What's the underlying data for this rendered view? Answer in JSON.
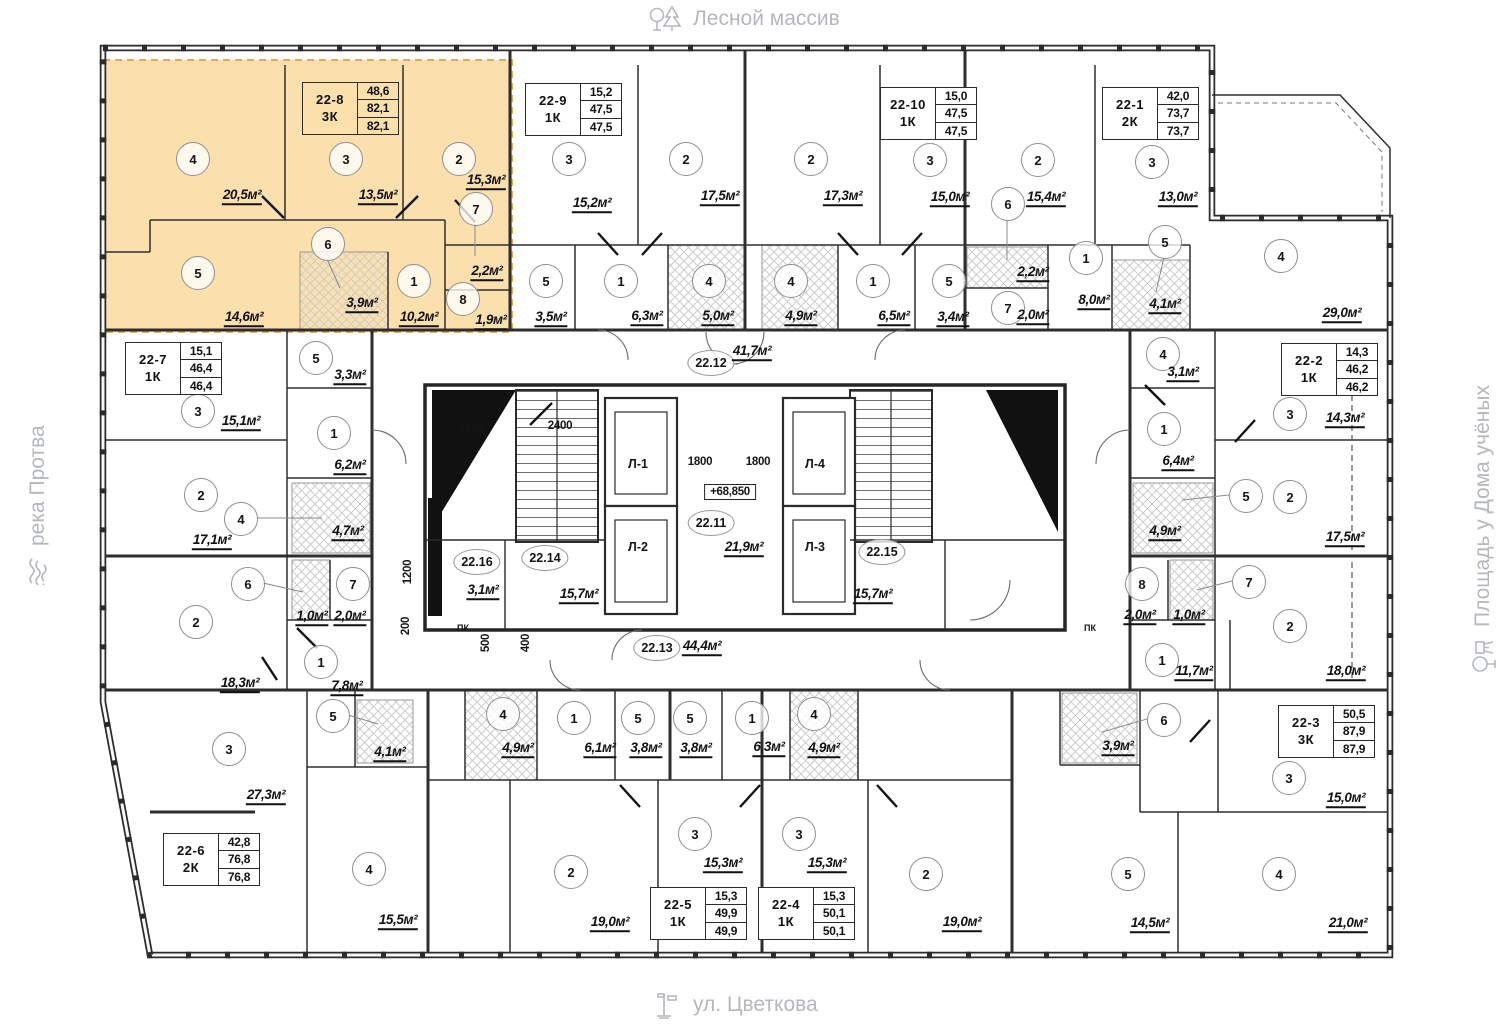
{
  "landmarks": {
    "top": {
      "label": "Лесной массив"
    },
    "bottom": {
      "label": "ул. Цветкова"
    },
    "left": {
      "label": "река Протва"
    },
    "right": {
      "label": "Площадь у Дома учёных"
    }
  },
  "colors": {
    "highlight_fill": "#FBDFA9",
    "highlight_border": "#DFA94E",
    "wall": "#2e2e2e",
    "landmark_text": "#b3b8bc"
  },
  "units": [
    {
      "id": "22-8",
      "type": "3К",
      "v1": "48,6",
      "v2": "82,1",
      "v3": "82,1",
      "x": 302,
      "y": 82,
      "highlighted": true
    },
    {
      "id": "22-9",
      "type": "1К",
      "v1": "15,2",
      "v2": "47,5",
      "v3": "47,5",
      "x": 525,
      "y": 83
    },
    {
      "id": "22-10",
      "type": "1К",
      "v1": "15,0",
      "v2": "47,5",
      "v3": "47,5",
      "x": 880,
      "y": 87
    },
    {
      "id": "22-1",
      "type": "2К",
      "v1": "42,0",
      "v2": "73,7",
      "v3": "73,7",
      "x": 1102,
      "y": 87
    },
    {
      "id": "22-7",
      "type": "1К",
      "v1": "15,1",
      "v2": "46,4",
      "v3": "46,4",
      "x": 125,
      "y": 342
    },
    {
      "id": "22-2",
      "type": "1К",
      "v1": "14,3",
      "v2": "46,2",
      "v3": "46,2",
      "x": 1281,
      "y": 343
    },
    {
      "id": "22-6",
      "type": "2К",
      "v1": "42,8",
      "v2": "76,8",
      "v3": "76,8",
      "x": 163,
      "y": 833
    },
    {
      "id": "22-5",
      "type": "1К",
      "v1": "15,3",
      "v2": "49,9",
      "v3": "49,9",
      "x": 650,
      "y": 887
    },
    {
      "id": "22-4",
      "type": "1К",
      "v1": "15,3",
      "v2": "50,1",
      "v3": "50,1",
      "x": 758,
      "y": 887
    },
    {
      "id": "22-3",
      "type": "3К",
      "v1": "50,5",
      "v2": "87,9",
      "v3": "87,9",
      "x": 1278,
      "y": 705
    }
  ],
  "rooms": [
    {
      "n": "4",
      "cx": 192,
      "cy": 158,
      "area": "20,5м²",
      "ax": 242,
      "ay": 196
    },
    {
      "n": "3",
      "cx": 345,
      "cy": 158,
      "area": "13,5м²",
      "ax": 378,
      "ay": 196
    },
    {
      "n": "2",
      "cx": 458,
      "cy": 158,
      "area": "15,3м²",
      "ax": 486,
      "ay": 181
    },
    {
      "n": "7",
      "cx": 475,
      "cy": 208,
      "area": "2,2м²",
      "ax": 487,
      "ay": 272,
      "leader": [
        475,
        224,
        475,
        256
      ]
    },
    {
      "n": "5",
      "cx": 197,
      "cy": 272,
      "area": "14,6м²",
      "ax": 244,
      "ay": 318
    },
    {
      "n": "6",
      "cx": 327,
      "cy": 243,
      "area": "3,9м²",
      "ax": 362,
      "ay": 304,
      "leader": [
        327,
        259,
        340,
        288
      ]
    },
    {
      "n": "1",
      "cx": 413,
      "cy": 280,
      "area": "10,2м²",
      "ax": 419,
      "ay": 318
    },
    {
      "n": "8",
      "cx": 462,
      "cy": 298,
      "area": "1,9м²",
      "ax": 491,
      "ay": 321
    },
    {
      "n": "3",
      "cx": 568,
      "cy": 158,
      "area": "15,2м²",
      "ax": 592,
      "ay": 204
    },
    {
      "n": "2",
      "cx": 685,
      "cy": 158,
      "area": "17,5м²",
      "ax": 720,
      "ay": 197
    },
    {
      "n": "5",
      "cx": 545,
      "cy": 280,
      "area": "3,5м²",
      "ax": 551,
      "ay": 318
    },
    {
      "n": "1",
      "cx": 620,
      "cy": 280,
      "area": "6,3м²",
      "ax": 647,
      "ay": 317
    },
    {
      "n": "4",
      "cx": 708,
      "cy": 280,
      "area": "5,0м²",
      "ax": 718,
      "ay": 317
    },
    {
      "n": "2",
      "cx": 810,
      "cy": 158,
      "area": "17,3м²",
      "ax": 843,
      "ay": 197
    },
    {
      "n": "3",
      "cx": 929,
      "cy": 159,
      "area": "15,0м²",
      "ax": 950,
      "ay": 198
    },
    {
      "n": "4",
      "cx": 790,
      "cy": 280,
      "area": "4,9м²",
      "ax": 801,
      "ay": 317
    },
    {
      "n": "1",
      "cx": 872,
      "cy": 280,
      "area": "6,5м²",
      "ax": 894,
      "ay": 317
    },
    {
      "n": "5",
      "cx": 948,
      "cy": 280,
      "area": "3,4м²",
      "ax": 953,
      "ay": 318
    },
    {
      "n": "2",
      "cx": 1037,
      "cy": 159,
      "area": "15,4м²",
      "ax": 1046,
      "ay": 198
    },
    {
      "n": "3",
      "cx": 1151,
      "cy": 161,
      "area": "13,0м²",
      "ax": 1178,
      "ay": 198
    },
    {
      "n": "6",
      "cx": 1007,
      "cy": 203,
      "area": "2,2м²",
      "ax": 1033,
      "ay": 273,
      "leader": [
        1007,
        219,
        1007,
        260
      ]
    },
    {
      "n": "1",
      "cx": 1085,
      "cy": 257,
      "area": "8,0м²",
      "ax": 1094,
      "ay": 301
    },
    {
      "n": "5",
      "cx": 1164,
      "cy": 241,
      "area": "4,1м²",
      "ax": 1165,
      "ay": 305,
      "leader": [
        1164,
        257,
        1156,
        292
      ]
    },
    {
      "n": "7",
      "cx": 1007,
      "cy": 307,
      "area": "2,0м²",
      "ax": 1033,
      "ay": 316
    },
    {
      "n": "4",
      "cx": 1280,
      "cy": 255,
      "area": "29,0м²",
      "ax": 1342,
      "ay": 314
    },
    {
      "n": "3",
      "cx": 197,
      "cy": 410,
      "area": "15,1м²",
      "ax": 241,
      "ay": 422
    },
    {
      "n": "5",
      "cx": 315,
      "cy": 357,
      "area": "3,3м²",
      "ax": 350,
      "ay": 376
    },
    {
      "n": "1",
      "cx": 333,
      "cy": 432,
      "area": "6,2м²",
      "ax": 350,
      "ay": 466
    },
    {
      "n": "2",
      "cx": 200,
      "cy": 494,
      "area": "17,1м²",
      "ax": 212,
      "ay": 541
    },
    {
      "n": "4",
      "cx": 240,
      "cy": 518,
      "area": "4,7м²",
      "ax": 348,
      "ay": 532,
      "leader": [
        256,
        518,
        322,
        518
      ]
    },
    {
      "n": "2",
      "cx": 195,
      "cy": 621,
      "area": "18,3м²",
      "ax": 240,
      "ay": 684
    },
    {
      "n": "6",
      "cx": 247,
      "cy": 583,
      "area": "1,0м²",
      "ax": 312,
      "ay": 617,
      "leader": [
        263,
        583,
        303,
        592
      ]
    },
    {
      "n": "7",
      "cx": 352,
      "cy": 583,
      "area": "2,0м²",
      "ax": 350,
      "ay": 617
    },
    {
      "n": "1",
      "cx": 320,
      "cy": 661,
      "area": "7,8м²",
      "ax": 347,
      "ay": 687
    },
    {
      "n": "5",
      "cx": 332,
      "cy": 715,
      "area": "4,1м²",
      "ax": 390,
      "ay": 753,
      "leader": [
        348,
        715,
        378,
        724
      ]
    },
    {
      "n": "3",
      "cx": 228,
      "cy": 748,
      "area": "27,3м²",
      "ax": 266,
      "ay": 796
    },
    {
      "n": "4",
      "cx": 368,
      "cy": 868,
      "area": "15,5м²",
      "ax": 398,
      "ay": 921
    },
    {
      "n": "4",
      "cx": 502,
      "cy": 713,
      "area": "4,9м²",
      "ax": 518,
      "ay": 749
    },
    {
      "n": "1",
      "cx": 573,
      "cy": 717,
      "area": "6,1м²",
      "ax": 600,
      "ay": 749
    },
    {
      "n": "5",
      "cx": 637,
      "cy": 717,
      "area": "3,8м²",
      "ax": 646,
      "ay": 749
    },
    {
      "n": "5",
      "cx": 689,
      "cy": 717,
      "area": "3,8м²",
      "ax": 696,
      "ay": 749
    },
    {
      "n": "1",
      "cx": 751,
      "cy": 717,
      "area": "6,3м²",
      "ax": 769,
      "ay": 748
    },
    {
      "n": "4",
      "cx": 813,
      "cy": 713,
      "area": "4,9м²",
      "ax": 824,
      "ay": 749
    },
    {
      "n": "2",
      "cx": 570,
      "cy": 871,
      "area": "19,0м²",
      "ax": 610,
      "ay": 923
    },
    {
      "n": "3",
      "cx": 694,
      "cy": 833,
      "area": "15,3м²",
      "ax": 723,
      "ay": 864
    },
    {
      "n": "3",
      "cx": 798,
      "cy": 833,
      "area": "15,3м²",
      "ax": 827,
      "ay": 864
    },
    {
      "n": "2",
      "cx": 925,
      "cy": 873,
      "area": "19,0м²",
      "ax": 962,
      "ay": 923
    },
    {
      "n": "6",
      "cx": 1163,
      "cy": 719,
      "area": "3,9м²",
      "ax": 1118,
      "ay": 747,
      "leader": [
        1147,
        719,
        1102,
        732
      ]
    },
    {
      "n": "3",
      "cx": 1288,
      "cy": 777,
      "area": "15,0м²",
      "ax": 1346,
      "ay": 799
    },
    {
      "n": "5",
      "cx": 1127,
      "cy": 873,
      "area": "14,5м²",
      "ax": 1150,
      "ay": 924
    },
    {
      "n": "4",
      "cx": 1278,
      "cy": 873,
      "area": "21,0м²",
      "ax": 1348,
      "ay": 924
    },
    {
      "n": "4",
      "cx": 1162,
      "cy": 353,
      "area": "3,1м²",
      "ax": 1183,
      "ay": 373
    },
    {
      "n": "1",
      "cx": 1163,
      "cy": 428,
      "area": "6,4м²",
      "ax": 1178,
      "ay": 462
    },
    {
      "n": "3",
      "cx": 1289,
      "cy": 413,
      "area": "14,3м²",
      "ax": 1345,
      "ay": 419
    },
    {
      "n": "5",
      "cx": 1245,
      "cy": 495,
      "area": "4,9м²",
      "ax": 1165,
      "ay": 532,
      "leader": [
        1229,
        495,
        1182,
        500
      ]
    },
    {
      "n": "2",
      "cx": 1289,
      "cy": 496,
      "area": "17,5м²",
      "ax": 1345,
      "ay": 538
    },
    {
      "n": "8",
      "cx": 1141,
      "cy": 583,
      "area": "2,0м²",
      "ax": 1140,
      "ay": 616
    },
    {
      "n": "7",
      "cx": 1248,
      "cy": 581,
      "area": "1,0м²",
      "ax": 1189,
      "ay": 616,
      "leader": [
        1232,
        581,
        1197,
        590
      ]
    },
    {
      "n": "2",
      "cx": 1289,
      "cy": 625,
      "area": "18,0м²",
      "ax": 1346,
      "ay": 672
    },
    {
      "n": "1",
      "cx": 1161,
      "cy": 659,
      "area": "11,7м²",
      "ax": 1194,
      "ay": 672
    }
  ],
  "core_labels": [
    {
      "text": "22.12",
      "x": 711,
      "y": 363,
      "circle": true
    },
    {
      "text": "41,7м²",
      "x": 752,
      "y": 352,
      "area": true
    },
    {
      "text": "22.11",
      "x": 711,
      "y": 523,
      "circle": true
    },
    {
      "text": "21,9м²",
      "x": 744,
      "y": 548,
      "area": true
    },
    {
      "text": "22.13",
      "x": 657,
      "y": 648,
      "circle": true
    },
    {
      "text": "44,4м²",
      "x": 702,
      "y": 647,
      "area": true
    },
    {
      "text": "22.14",
      "x": 545,
      "y": 558,
      "circle": true
    },
    {
      "text": "15,7м²",
      "x": 579,
      "y": 595,
      "area": true
    },
    {
      "text": "22.15",
      "x": 882,
      "y": 552,
      "circle": true
    },
    {
      "text": "15,7м²",
      "x": 873,
      "y": 595,
      "area": true
    },
    {
      "text": "22.16",
      "x": 477,
      "y": 562,
      "circle": true
    },
    {
      "text": "3,1м²",
      "x": 483,
      "y": 591,
      "area": true
    },
    {
      "text": "Л-1",
      "x": 638,
      "y": 464
    },
    {
      "text": "Л-2",
      "x": 638,
      "y": 547
    },
    {
      "text": "Л-4",
      "x": 815,
      "y": 464
    },
    {
      "text": "Л-3",
      "x": 815,
      "y": 547
    },
    {
      "text": "ПК",
      "x": 463,
      "y": 628,
      "small": true
    },
    {
      "text": "ПК",
      "x": 1090,
      "y": 628,
      "small": true
    }
  ],
  "dimensions": [
    {
      "text": "2450",
      "x": 471,
      "y": 429
    },
    {
      "text": "2400",
      "x": 560,
      "y": 426
    },
    {
      "text": "1800",
      "x": 700,
      "y": 462
    },
    {
      "text": "1800",
      "x": 758,
      "y": 462
    },
    {
      "text": "+68,850",
      "x": 730,
      "y": 492,
      "boxed": true
    },
    {
      "text": "1200",
      "x": 408,
      "y": 572,
      "rot": true
    },
    {
      "text": "200",
      "x": 406,
      "y": 626,
      "rot": true
    },
    {
      "text": "500",
      "x": 486,
      "y": 643,
      "rot": true
    },
    {
      "text": "400",
      "x": 526,
      "y": 643,
      "rot": true
    }
  ]
}
